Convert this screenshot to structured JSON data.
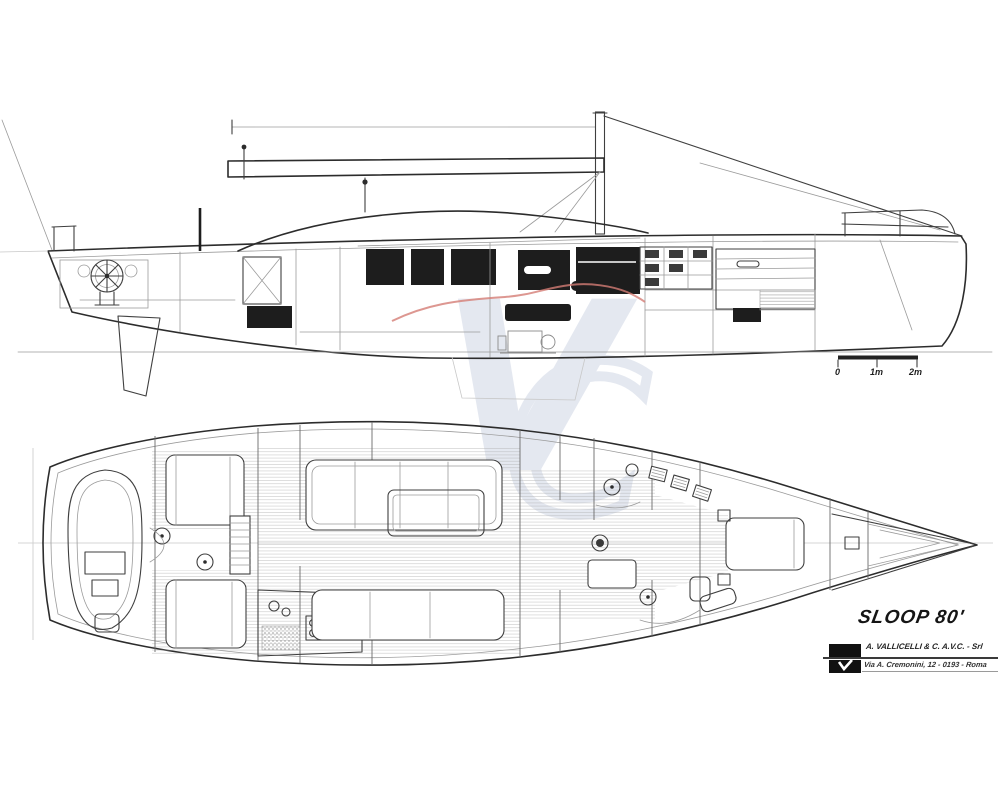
{
  "title": "SLOOP 80'",
  "designer_block": {
    "logo": "vallicelli-builder-logo",
    "line1": "A. VALLICELLI & C. A.V.C. - Srl",
    "line2": "Via A. Cremonini, 12 - 0193 - Roma"
  },
  "scale_bar": {
    "labels": [
      "0",
      "1m",
      "2m"
    ]
  },
  "watermark": {
    "letters": [
      "V",
      "C"
    ],
    "color": "#e2e6ef"
  },
  "accent_colors": {
    "red_sheer_accent": "#d57d76",
    "ink": "#3f3f3f"
  }
}
